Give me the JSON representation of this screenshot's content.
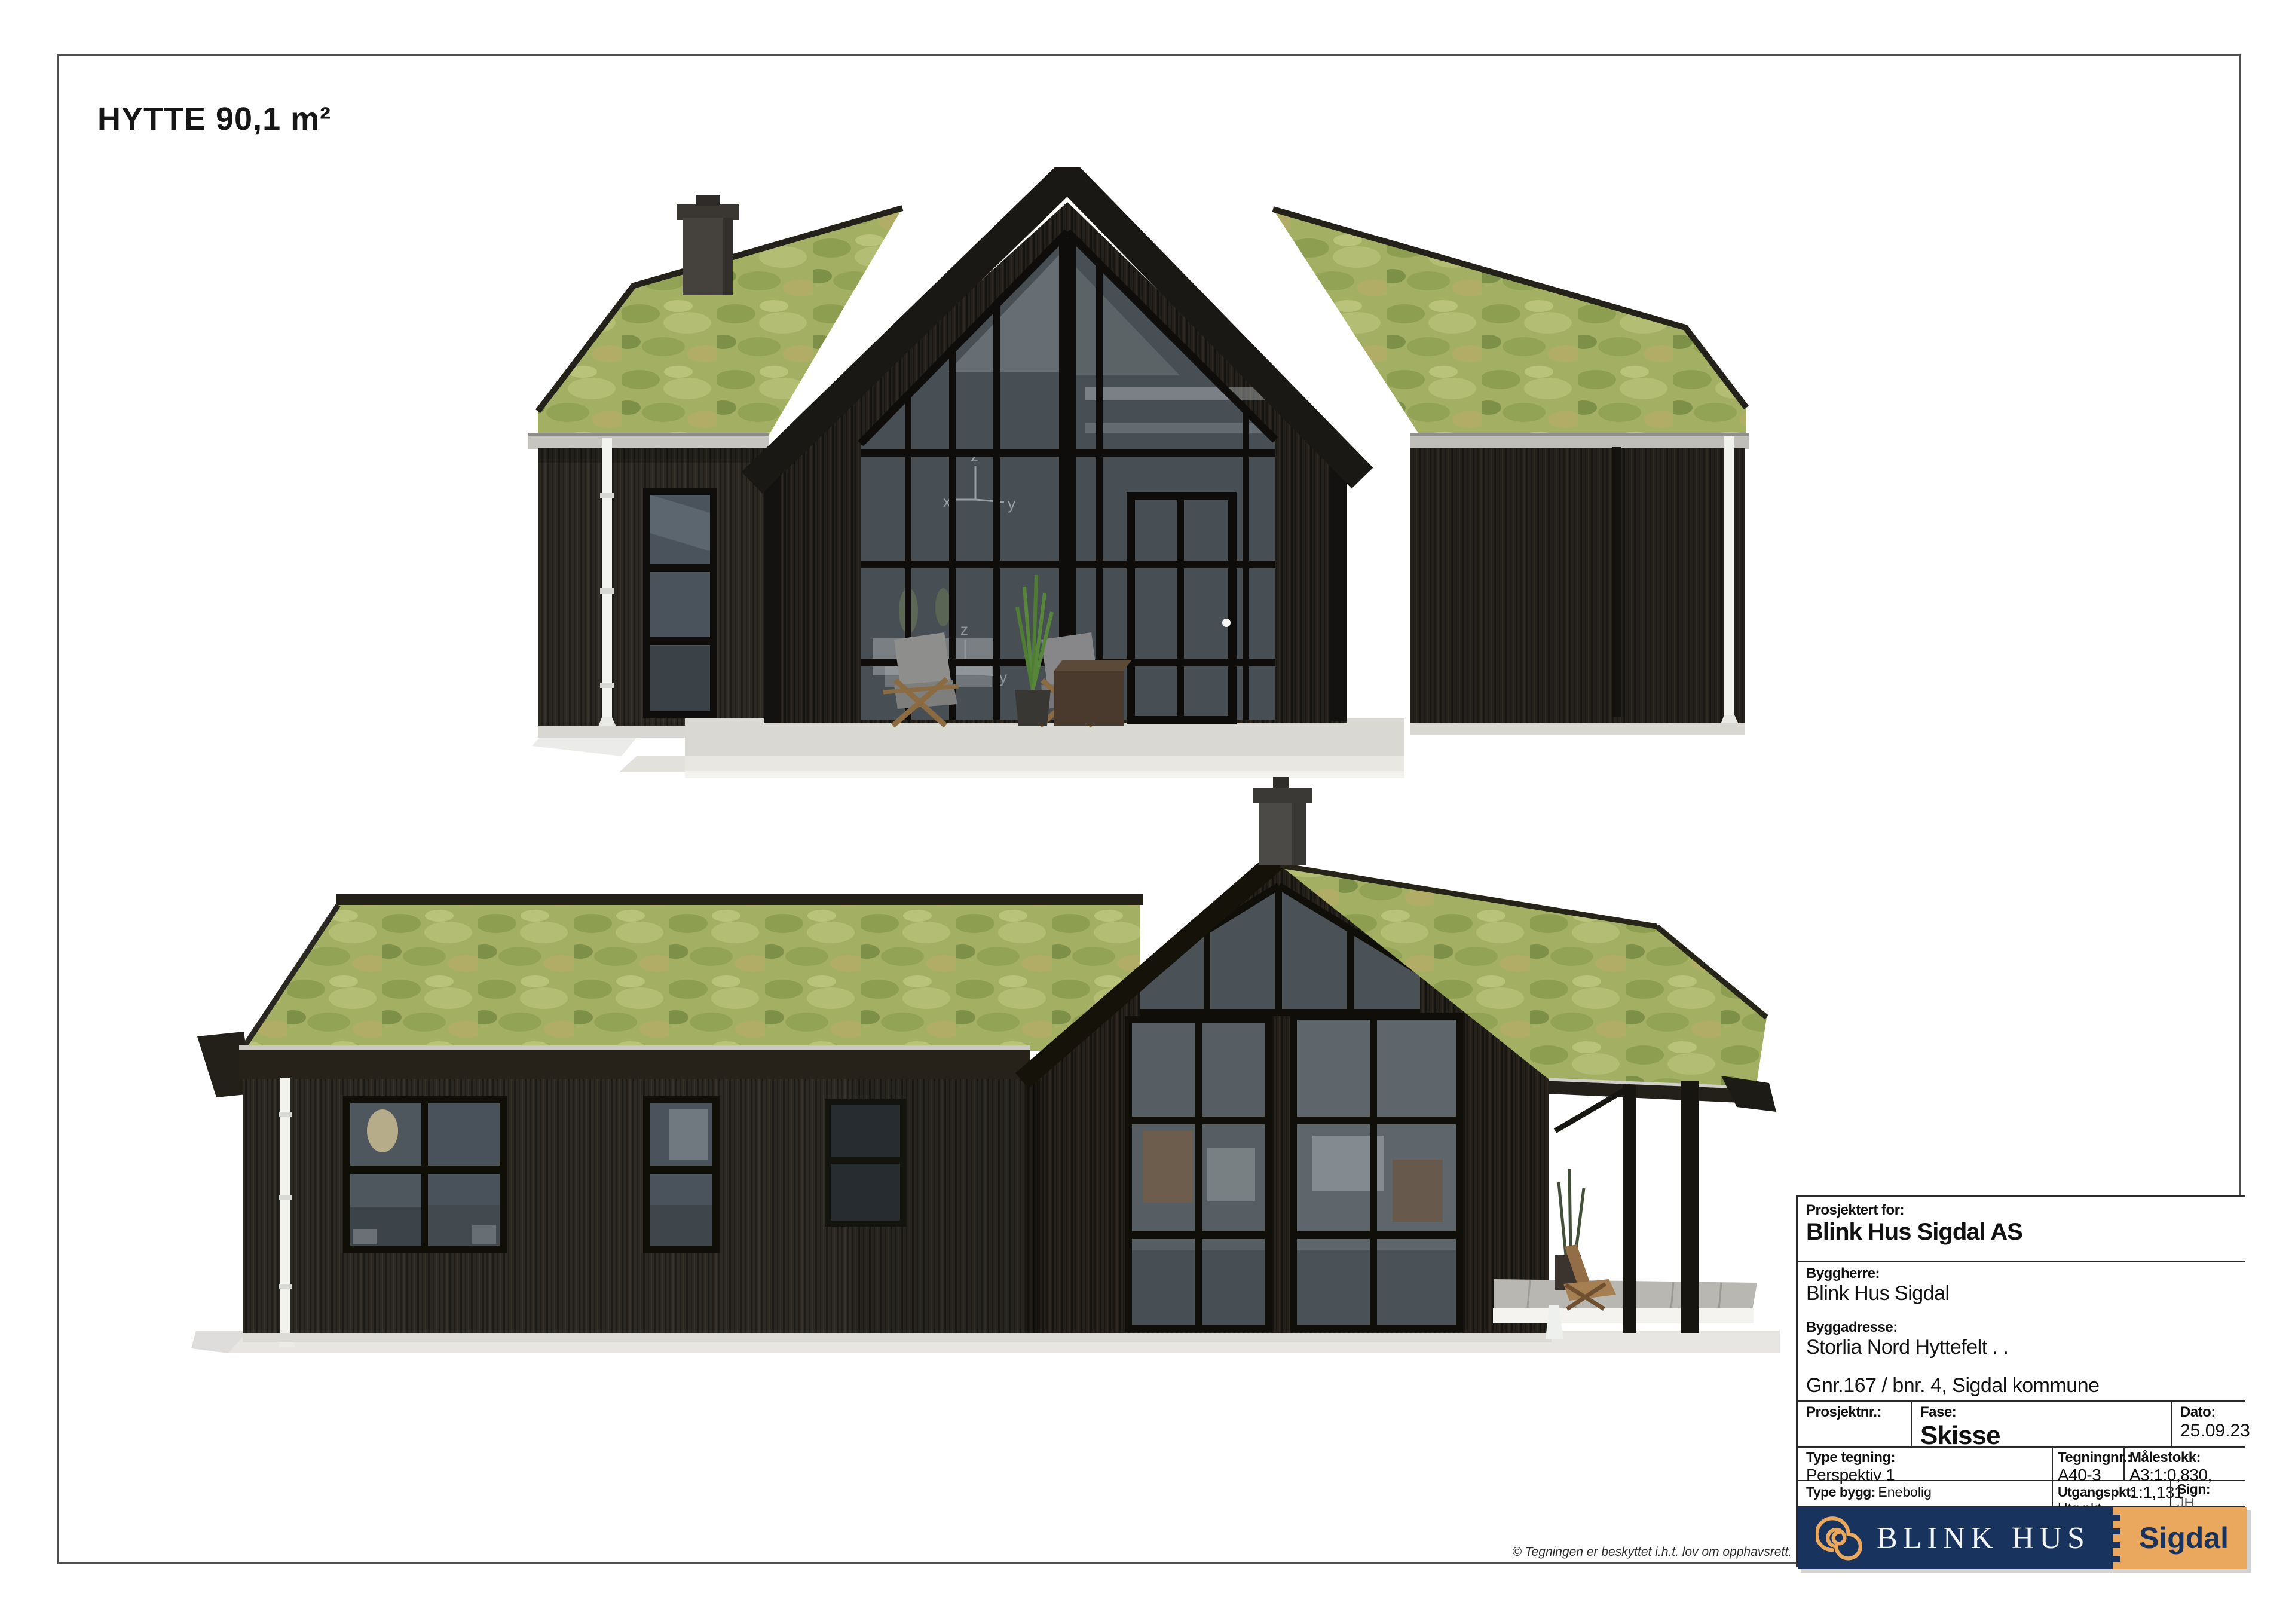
{
  "page": {
    "title": "HYTTE 90,1 m²",
    "copyright": "© Tegningen er beskyttet i.h.t. lov om opphavsrett."
  },
  "title_block": {
    "projected_for": {
      "label": "Prosjektert for:",
      "value": "Blink Hus Sigdal AS"
    },
    "client": {
      "label": "Byggherre:",
      "value": "Blink Hus Sigdal"
    },
    "site_address": {
      "label": "Byggadresse:",
      "value": "Storlia Nord Hyttefelt . .",
      "property": "Gnr.167 / bnr. 4, Sigdal kommune"
    },
    "project_no": {
      "label": "Prosjektnr.:",
      "value": ""
    },
    "phase": {
      "label": "Fase:",
      "value": "Skisse"
    },
    "date": {
      "label": "Dato:",
      "value": "25.09.23"
    },
    "drawing_type": {
      "label": "Type tegning:",
      "value": "Perspektiv 1"
    },
    "drawing_no": {
      "label": "Tegningnr.:",
      "value": "A40-3"
    },
    "scale": {
      "label": "Målestokk:",
      "value": "A3:1:0,830, 1:1,131"
    },
    "building_type": {
      "label": "Type bygg:",
      "value": "Enebolig"
    },
    "origin": {
      "label": "Utgangspkt:",
      "value": "Utg.pkt."
    },
    "sign": {
      "label": "Sign:",
      "value": "JH"
    }
  },
  "logo": {
    "brand": "BLINK HUS",
    "region": "Sigdal",
    "icon": "spiral-logo-icon"
  },
  "render_artifacts": {
    "axis_x": "x",
    "axis_y": "y",
    "axis_z": "z"
  },
  "colors": {
    "logo_navy": "#17335e",
    "logo_tan": "#e9a85e",
    "roof_green": "#a3b064",
    "wood_dark": "#2b2822",
    "frame_border": "#4f4f4f"
  }
}
